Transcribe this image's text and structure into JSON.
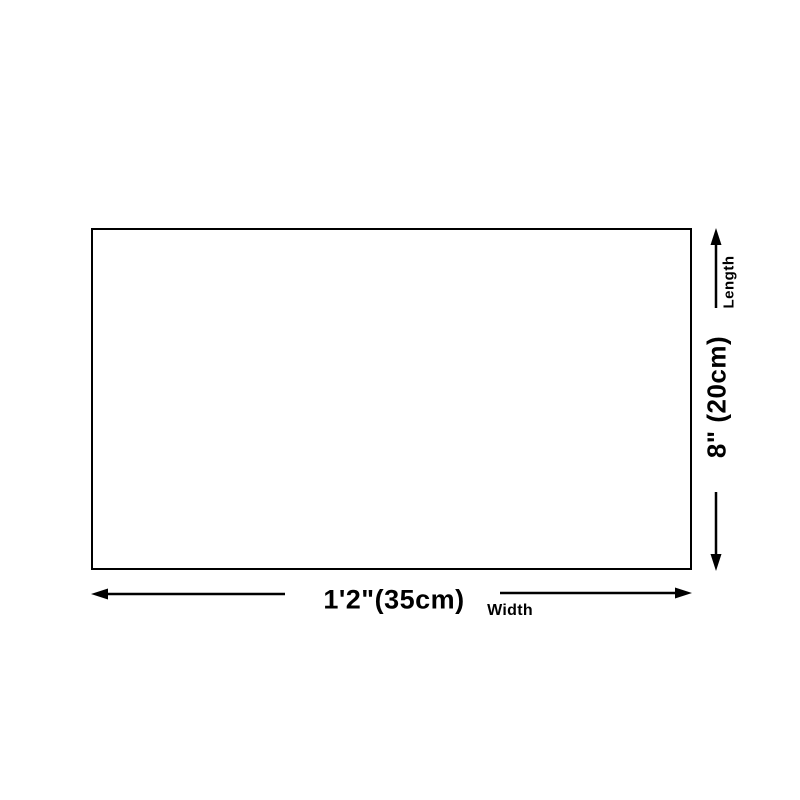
{
  "page": {
    "background_color": "#ffffff"
  },
  "diagram": {
    "type": "product-dimension-diagram",
    "rectangle": {
      "border_color": "#000000",
      "fill_color": "#ffffff"
    },
    "line_color": "#000000",
    "width": {
      "value": "1'2\"(35cm)",
      "caption": "Width"
    },
    "length": {
      "value": "8\" (20cm)",
      "caption": "Length"
    },
    "icons": {
      "arrow_left": "left-arrow-icon",
      "arrow_right": "right-arrow-icon",
      "arrow_up": "up-arrow-icon",
      "arrow_down": "down-arrow-icon"
    }
  }
}
